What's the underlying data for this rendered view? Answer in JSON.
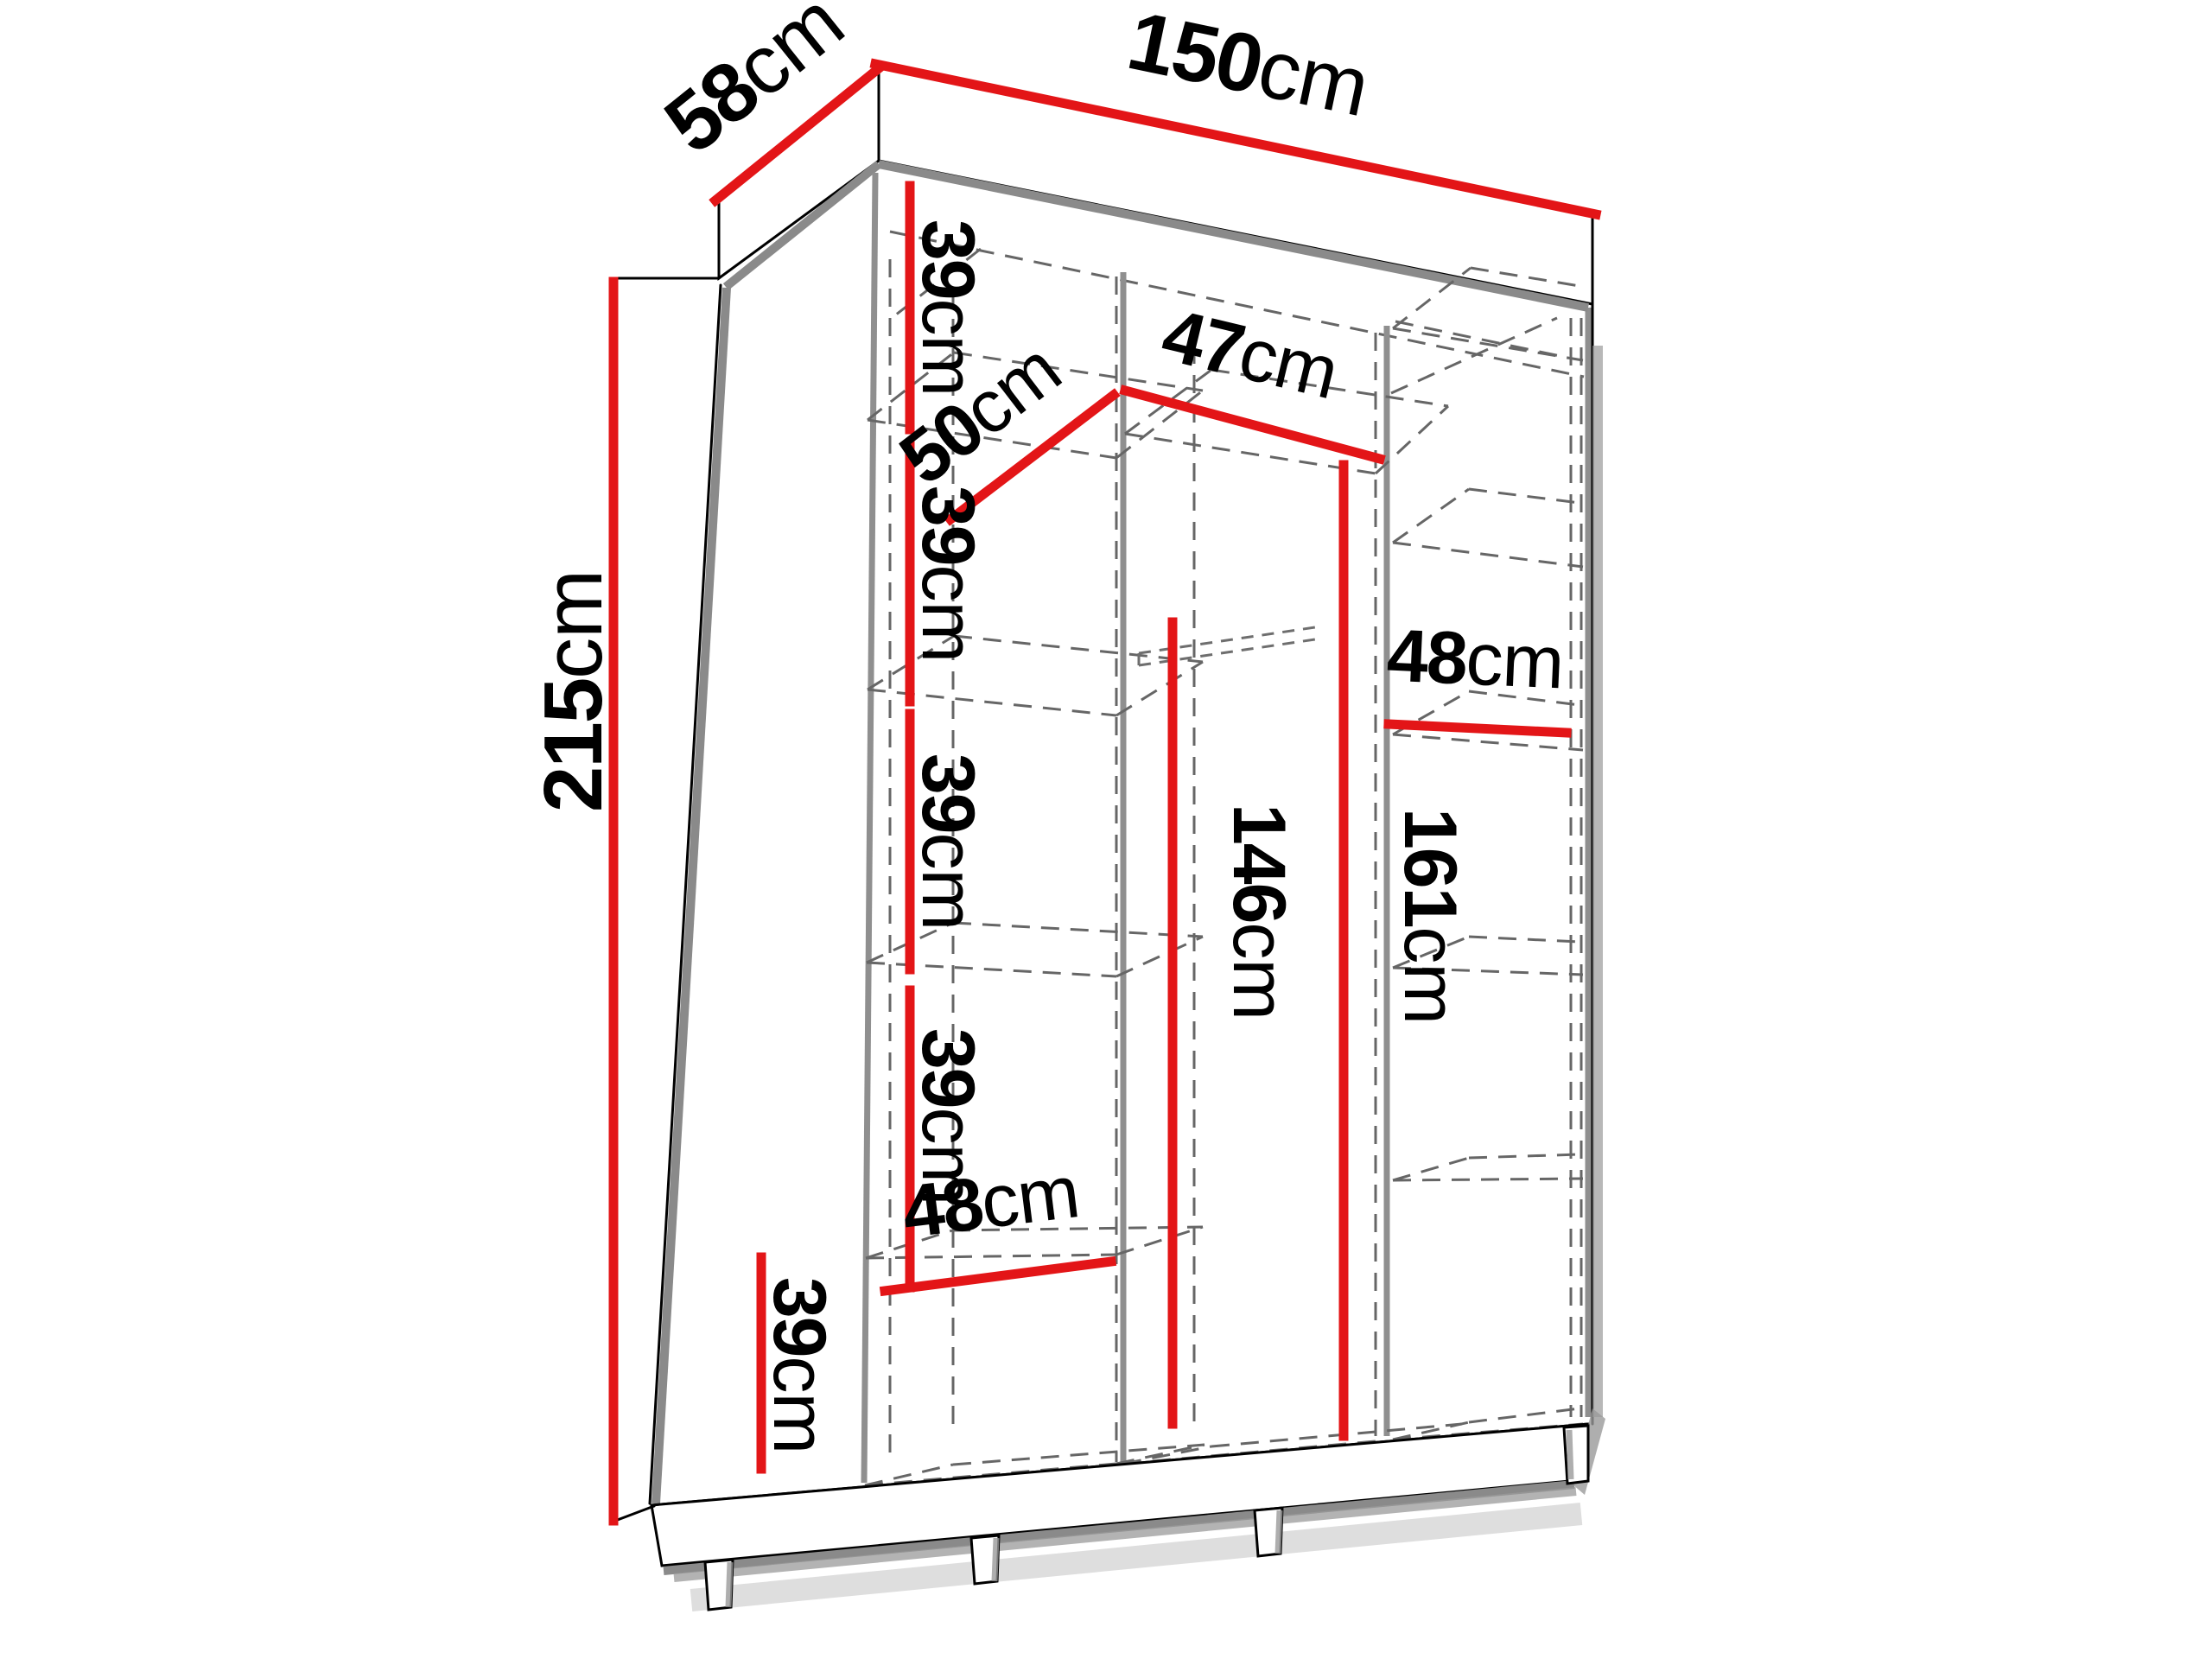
{
  "figure": {
    "kind": "wardrobe dimension diagram",
    "background": "#ffffff"
  },
  "colors": {
    "dimension_line": "#e31517",
    "edge_highlight": "#8a8a8a",
    "outline": "#000000",
    "hidden_line": "#666666",
    "shadow": "#9a9a9a"
  },
  "dimensions": {
    "width": {
      "value": "150",
      "unit": "cm"
    },
    "depth": {
      "value": "58",
      "unit": "cm"
    },
    "height": {
      "value": "215",
      "unit": "cm"
    },
    "left_gaps": [
      {
        "value": "39",
        "unit": "cm"
      },
      {
        "value": "39",
        "unit": "cm"
      },
      {
        "value": "39",
        "unit": "cm"
      },
      {
        "value": "39",
        "unit": "cm"
      },
      {
        "value": "39",
        "unit": "cm"
      }
    ],
    "left_depth": {
      "value": "50",
      "unit": "cm"
    },
    "middle_width": {
      "value": "47",
      "unit": "cm"
    },
    "right_width": {
      "value": "48",
      "unit": "cm"
    },
    "left_bottom_width": {
      "value": "48",
      "unit": "cm"
    },
    "middle_inner_height": {
      "value": "146",
      "unit": "cm"
    },
    "middle_opening_height": {
      "value": "161",
      "unit": "cm"
    }
  }
}
